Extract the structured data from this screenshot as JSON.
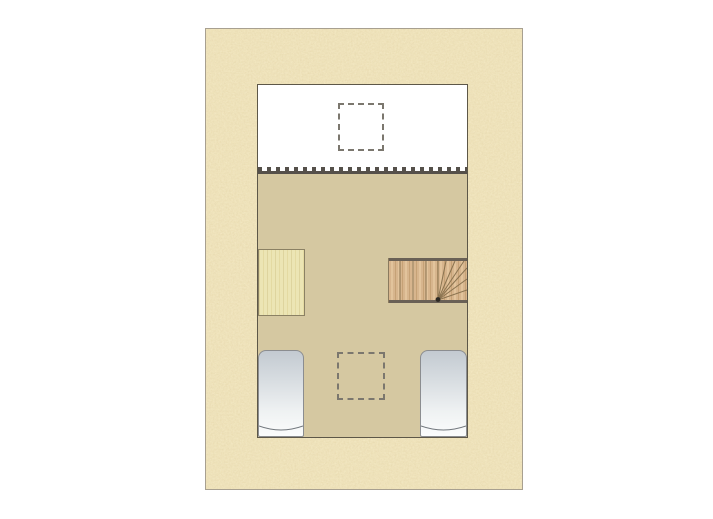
{
  "document": {
    "kind": "architectural floor plan, attic storey, no text labels"
  },
  "palette": {
    "page_background": "#ffffff",
    "wall_texture_base": "#f2e6bc",
    "wall_texture_speckle": "#a88745",
    "outer_border": "#a8a090",
    "interior_outline": "#5d5748",
    "upper_room_fill": "#ffffff",
    "lower_room_fill": "#d5c8a1",
    "dashed_outline": "#7b776e",
    "balustrade_dark": "#55504a",
    "wardrobe_wood": "#ece5b4",
    "wardrobe_outline": "#8b8164",
    "stair_wood": "#d7b58d",
    "stair_stringer": "#6a6156",
    "stair_line": "#8a7350",
    "bed_fill_top": "#c3cad1",
    "bed_fill_bottom": "#fbfcfc",
    "bed_outline": "#8b8d90"
  },
  "features": [
    {
      "name": "textured-wall-surround"
    },
    {
      "name": "upper-room"
    },
    {
      "name": "skylight-dashed-upper"
    },
    {
      "name": "balustrade"
    },
    {
      "name": "lower-room"
    },
    {
      "name": "wardrobe"
    },
    {
      "name": "winder-staircase"
    },
    {
      "name": "skylight-dashed-lower"
    },
    {
      "name": "bed-left"
    },
    {
      "name": "bed-right"
    }
  ]
}
